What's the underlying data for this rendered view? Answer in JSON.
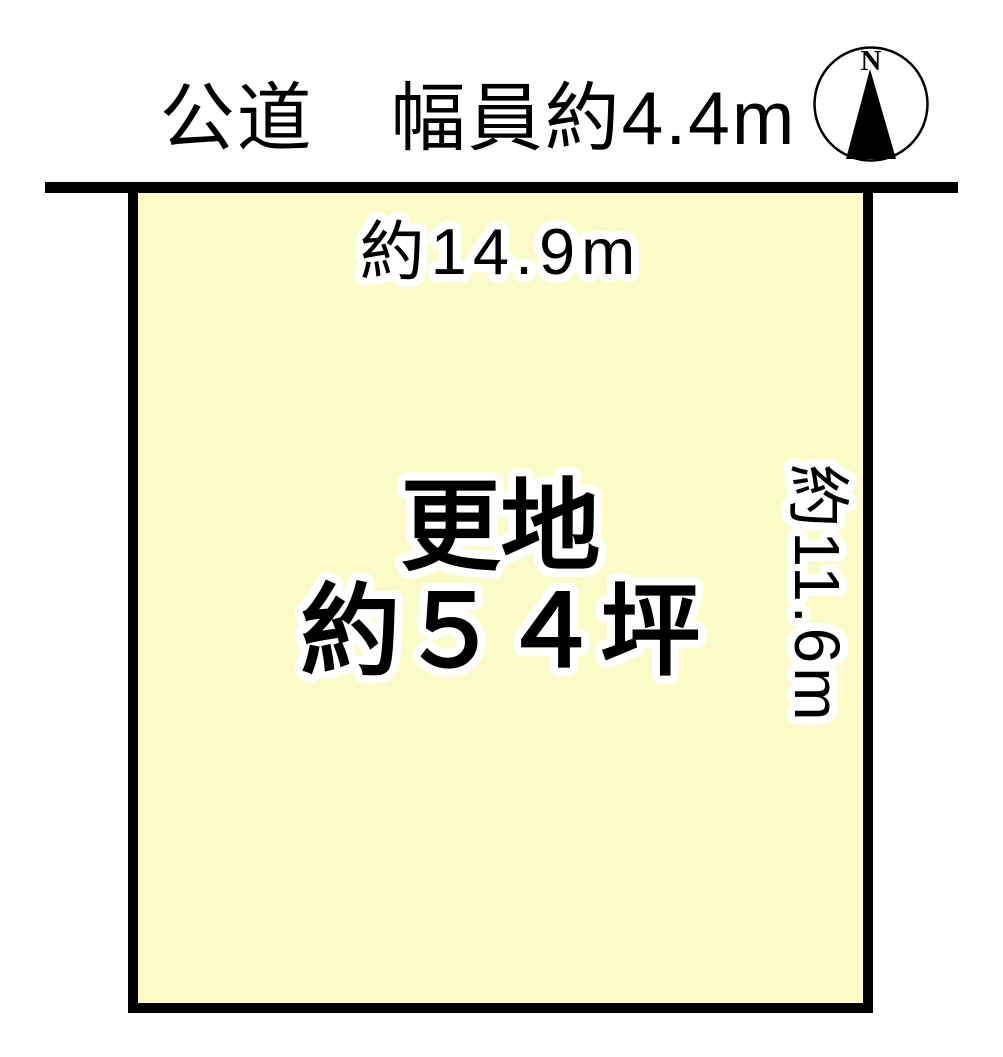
{
  "page": {
    "background_color": "#ffffff",
    "type": "land-plot-diagram"
  },
  "road": {
    "label": "公道　幅員約4.4m",
    "line_color": "#000000"
  },
  "compass": {
    "north_label": "N",
    "arrow_color": "#000000"
  },
  "plot": {
    "fill_color": "#fbfbc8",
    "border_color": "#000000",
    "top_dimension": "約14.9m",
    "side_dimension": "約11.6m",
    "label_line1": "更地",
    "label_line2": "約５４坪"
  }
}
